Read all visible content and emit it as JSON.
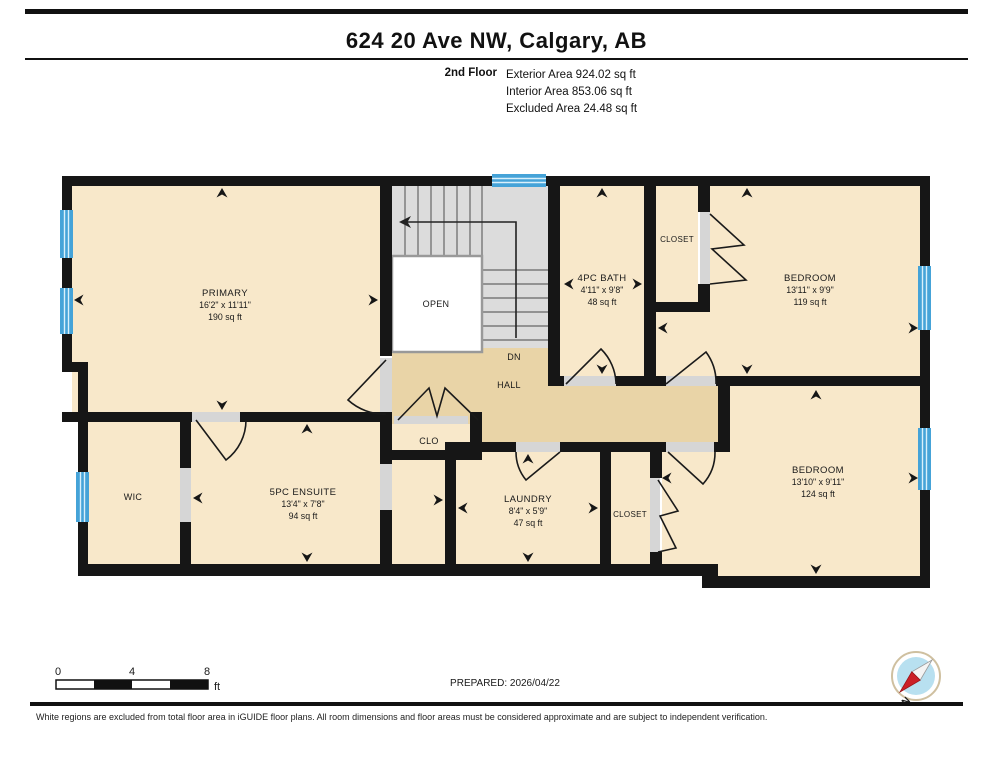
{
  "header": {
    "title": "624 20 Ave NW, Calgary, AB",
    "floor_label": "2nd Floor",
    "area_lines": [
      "Exterior Area 924.02 sq ft",
      "Interior Area 853.06 sq ft",
      "Excluded Area 24.48 sq ft"
    ]
  },
  "plan": {
    "rooms": {
      "primary": {
        "name": "PRIMARY",
        "dims": "16'2\" x 11'11\"",
        "area": "190 sq ft"
      },
      "open": {
        "name": "OPEN"
      },
      "dn": {
        "name": "DN"
      },
      "hall": {
        "name": "HALL"
      },
      "bath": {
        "name": "4PC BATH",
        "dims": "4'11\" x 9'8\"",
        "area": "48 sq ft"
      },
      "closet_top": {
        "name": "CLOSET"
      },
      "bedroom_top": {
        "name": "BEDROOM",
        "dims": "13'11\" x 9'9\"",
        "area": "119 sq ft"
      },
      "clo": {
        "name": "CLO"
      },
      "wic": {
        "name": "WIC"
      },
      "ensuite": {
        "name": "5PC ENSUITE",
        "dims": "13'4\" x 7'8\"",
        "area": "94 sq ft"
      },
      "laundry": {
        "name": "LAUNDRY",
        "dims": "8'4\" x 5'9\"",
        "area": "47 sq ft"
      },
      "closet_bottom": {
        "name": "CLOSET"
      },
      "bedroom_bottom": {
        "name": "BEDROOM",
        "dims": "13'10\" x 9'11\"",
        "area": "124 sq ft"
      }
    },
    "colors": {
      "room_fill": "#f8e8ca",
      "hall_fill": "#e9d4a7",
      "stairs_fill": "#dcdcdc",
      "excluded_fill": "#ffffff",
      "wall": "#161616",
      "window_blue": "#45a3d8",
      "door_sill_gray": "#d6d6d6"
    }
  },
  "footer": {
    "scale": {
      "ticks": [
        "0",
        "4",
        "8"
      ],
      "unit": "ft"
    },
    "prepared": "PREPARED: 2026/04/22",
    "compass_north_label": "N",
    "disclaimer": "White regions are excluded from total floor area in iGUIDE floor plans. All room dimensions and floor areas must be considered approximate and are subject to independent verification."
  }
}
